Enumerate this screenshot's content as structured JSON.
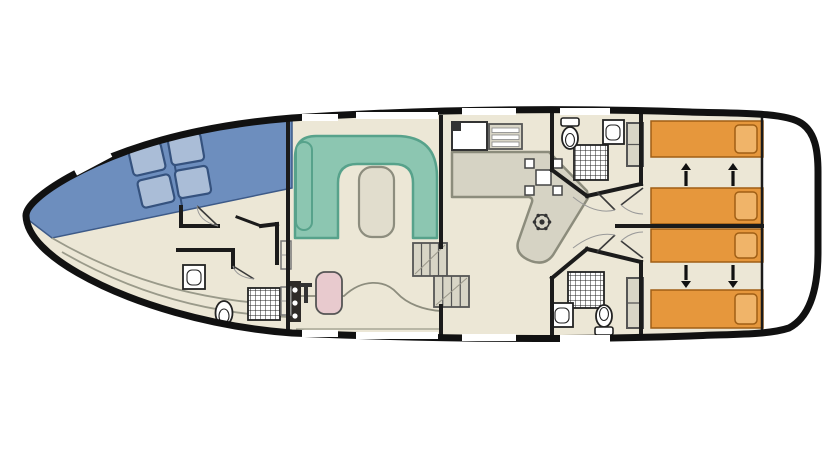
{
  "meta": {
    "type": "boat-floor-plan",
    "description": "top-view deck plan of a canal houseboat"
  },
  "colors": {
    "hull_line": "#111111",
    "floor": "#ece7d6",
    "exterior": "#ffffff",
    "deck_blue": "#6d8ebe",
    "deck_blue_edge": "#3d5a88",
    "cushion_fill": "#aabdd7",
    "cushion_border": "#35527e",
    "sofa_fill": "#8cc6b1",
    "sofa_border": "#57a28b",
    "table_fill": "#e1ddcd",
    "table_border": "#8d8d7e",
    "helm_fill": "#d6d3c4",
    "helm_border": "#8c8c7c",
    "bed_fill": "#e6973c",
    "bed_border": "#a05f15",
    "pillow_fill": "#f0b469",
    "wall": "#1b1b1b",
    "fixture_line": "#222222",
    "gray_unit": "#d8d5c6",
    "unit_border": "#555555",
    "sink_pink": "#e8cace",
    "stove_dark": "#2e2b28",
    "door_line": "#3a3a3a",
    "door_arc": "#999999",
    "window": "#ffffff",
    "deck_line": "#9a9a8a",
    "arrow": "#111111"
  },
  "bow_deck": {
    "cushion_w": 33,
    "cushion_h": 28,
    "cushions": [
      {
        "cx": 147,
        "cy": 159,
        "rot": -13
      },
      {
        "cx": 156,
        "cy": 191,
        "rot": -13
      },
      {
        "cx": 186,
        "cy": 149,
        "rot": -10
      },
      {
        "cx": 193,
        "cy": 182,
        "rot": -10
      }
    ]
  },
  "windows": {
    "height": 7,
    "top": [
      [
        302,
        114,
        36
      ],
      [
        356,
        112,
        82
      ],
      [
        462,
        108,
        54
      ],
      [
        560,
        108,
        50
      ]
    ],
    "bottom": [
      [
        302,
        330,
        36
      ],
      [
        356,
        332,
        82
      ],
      [
        462,
        334,
        54
      ],
      [
        560,
        335,
        50
      ]
    ],
    "bow": {
      "cx": 93,
      "cy": 163,
      "w": 40,
      "h": 7,
      "rot": -28
    }
  },
  "cabins": {
    "beds": [
      {
        "x": 651,
        "y": 121,
        "w": 112,
        "h": 36
      },
      {
        "x": 651,
        "y": 188,
        "w": 112,
        "h": 36
      },
      {
        "x": 651,
        "y": 229,
        "w": 112,
        "h": 33
      },
      {
        "x": 651,
        "y": 290,
        "w": 112,
        "h": 38
      }
    ],
    "arrows": [
      {
        "x": 686,
        "from": 186,
        "to": 171,
        "tip": 163
      },
      {
        "x": 733,
        "from": 186,
        "to": 171,
        "tip": 163
      },
      {
        "x": 686,
        "from": 265,
        "to": 280,
        "tip": 288
      },
      {
        "x": 733,
        "from": 265,
        "to": 280,
        "tip": 288
      }
    ],
    "wardrobes": [
      {
        "x": 627,
        "y": 123,
        "w": 16,
        "h": 43
      },
      {
        "x": 627,
        "y": 278,
        "w": 16,
        "h": 50
      }
    ]
  },
  "salon": {
    "cabinets": [
      {
        "x": 281,
        "y": 241,
        "w": 10,
        "h": 28
      },
      {
        "x": 281,
        "y": 287,
        "w": 10,
        "h": 28
      }
    ]
  },
  "stairs": [
    {
      "x": 413,
      "y": 243,
      "w": 34,
      "h": 33
    },
    {
      "x": 434,
      "y": 276,
      "w": 35,
      "h": 31
    }
  ],
  "bathrooms": {
    "showers": [
      {
        "x": 574,
        "y": 145,
        "w": 34,
        "h": 35
      },
      {
        "x": 568,
        "y": 272,
        "w": 36,
        "h": 36
      },
      {
        "x": 248,
        "y": 288,
        "w": 32,
        "h": 32
      }
    ]
  },
  "walls": [
    [
      181,
      207,
      181,
      226
    ],
    [
      181,
      226,
      218,
      226
    ],
    [
      261,
      226,
      277,
      224
    ],
    [
      277,
      224,
      277,
      263
    ],
    [
      237,
      217,
      261,
      226,
      3
    ],
    [
      178,
      250,
      233,
      250
    ],
    [
      233,
      250,
      233,
      267
    ],
    [
      288,
      117,
      288,
      334
    ],
    [
      441,
      117,
      441,
      247
    ],
    [
      441,
      306,
      441,
      334
    ],
    [
      552,
      108,
      552,
      170
    ],
    [
      552,
      278,
      552,
      337
    ],
    [
      552,
      170,
      587,
      196
    ],
    [
      552,
      278,
      587,
      249
    ],
    [
      587,
      196,
      641,
      184
    ],
    [
      587,
      249,
      641,
      262
    ],
    [
      641,
      110,
      641,
      184
    ],
    [
      641,
      262,
      641,
      337
    ],
    [
      617,
      226,
      762,
      226
    ],
    [
      762,
      112,
      762,
      336,
      2.5
    ]
  ],
  "doors": [
    {
      "leaf": "M218 226 L197 206",
      "arc": "M197 206 Q198 221 218 226"
    },
    {
      "leaf": "M233 266 L254 279",
      "arc": "M233 266 Q236 277 254 279"
    },
    {
      "leaf": "M597 192 L615 210",
      "arc": "M573 197 Q595 215 615 210"
    },
    {
      "leaf": "M597 252 L615 235",
      "arc": "M573 248 Q595 231 615 235"
    },
    {
      "leaf": "M643 188 L621 205",
      "arc": "M643 214 Q631 214 621 205"
    },
    {
      "leaf": "M643 258 L621 241",
      "arc": "M643 232 Q631 232 621 241"
    }
  ]
}
